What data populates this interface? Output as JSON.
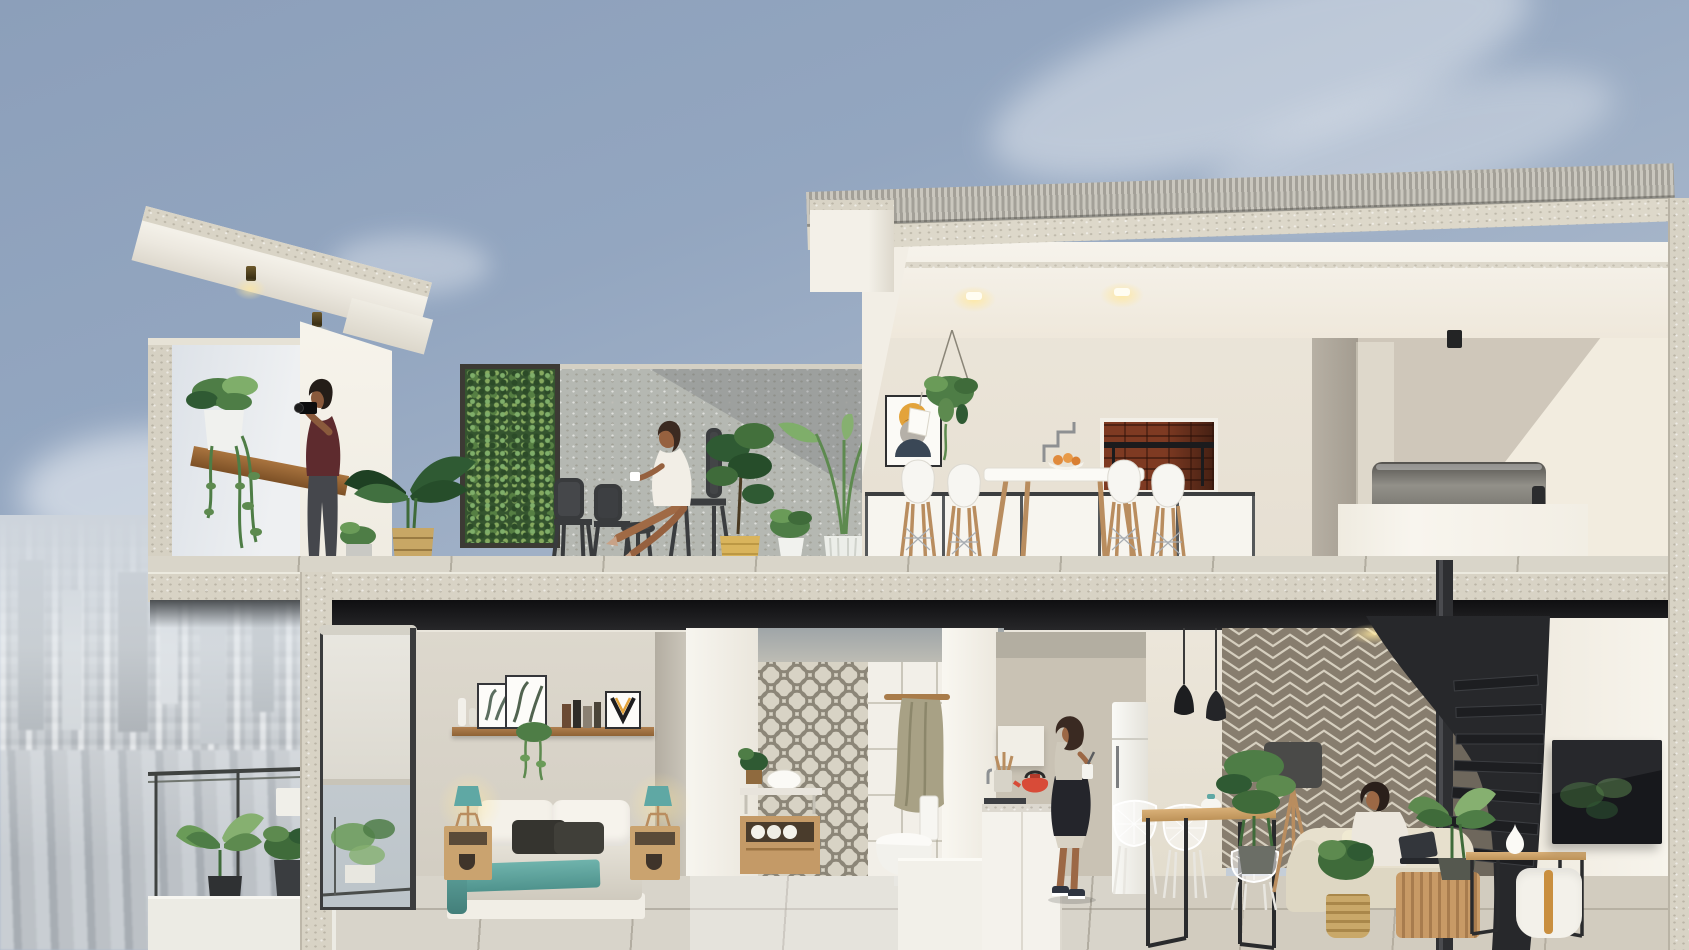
{
  "scene": {
    "type": "architectural cutaway render",
    "title": "Two-storey penthouse cross-section with roof terrace",
    "setting": "High-rise duplex apartment shown in section view against a hazy city skyline",
    "sky": "Soft blue-grey sky with thin cirrus clouds",
    "city": "Dense low-rise cityscape fading into haze at the lower left"
  },
  "palette": {
    "sky_top": "#8c9fba",
    "sky_low": "#cdd4dc",
    "cloud": "#ffffff",
    "concrete_cut": "#d8d3c5",
    "concrete_wall": "#b5b8b2",
    "white_wall": "#f4f1ea",
    "cream_wall": "#e9e3d7",
    "taupe_wall": "#cfc7ba",
    "shadow_gap": "#141416",
    "wood": "#b98d5f",
    "wood_dark": "#8e6234",
    "foliage_dark": "#2f5a33",
    "foliage": "#4e7d46",
    "foliage_light": "#7fae6a",
    "metal_dark": "#3a3c3e",
    "stair_black": "#27282b",
    "maroon_shirt": "#5e2b2e",
    "teal_accent": "#5fa8a4",
    "brick": "#7e3a22",
    "kettle_red": "#d84b38",
    "fruit_orange": "#e08a3c",
    "herringbone_base": "#877d6e",
    "herringbone_line": "#d6cfbf",
    "tile_pattern": "#8c8678",
    "sofa_cream": "#e7e0cd",
    "tv_black": "#17181c",
    "city_grey": "#b3b9bf"
  },
  "upper_floor": {
    "label": "Roof terrace level",
    "open_terrace": {
      "label": "Open roof terrace",
      "objects": [
        "cantilevered concrete canopy with two brass downlights",
        "concrete parapet with timber bar ledge",
        "trailing pothos in white pot",
        "living green wall in dark steel frame",
        "banana plant in woven basket",
        "potted ferns",
        "two dark metal bistro chairs",
        "metal side stool",
        "fiddle-leaf fig in yellow basket",
        "bird-of-paradise palm in white ribbed pot"
      ]
    },
    "covered_bar": {
      "label": "Covered roof kitchen and bar",
      "objects": [
        "corrugated metal roof on concrete fascia",
        "two recessed ceiling downlights",
        "framed abstract print with yellow, ochre, grey and navy circles",
        "hanging plant on ropes",
        "white pendant lamp",
        "brick barbecue niche with steel grill",
        "white high bar table",
        "bowl of oranges",
        "four white bar stools with timber dowel legs",
        "white balustrade with dark mullions",
        "steel plunge hot-tub behind white parapet",
        "black cylindrical ceiling spotlight"
      ]
    },
    "people": [
      {
        "id": "photographer",
        "description": "Bearded man in a maroon t-shirt and grey trousers photographing the view with a DSLR camera"
      },
      {
        "id": "woman_with_coffee",
        "description": "Woman in a white summer dress sitting cross-legged on a metal chair holding a coffee cup"
      }
    ]
  },
  "lower_floor": {
    "label": "Apartment level",
    "balcony": {
      "label": "Bedroom balcony",
      "objects": [
        "dark metal railing",
        "white planter box",
        "potted monstera and philodendron plants",
        "plant stand"
      ]
    },
    "bedroom": {
      "label": "Bedroom",
      "objects": [
        "sliding glass door with roller blind",
        "timber picture shelf",
        "two leaning botanical prints",
        "row of books",
        "letter-V artwork",
        "trailing plant",
        "double bed with grey duvet and teal throw",
        "white and charcoal pillows",
        "two timber nightstands",
        "two teal tripod table lamps"
      ]
    },
    "bathroom": {
      "label": "Bathroom",
      "objects": [
        "grey patterned feature tiles",
        "white wall tiles",
        "timber hook rail with towel",
        "floating timber vanity with vessel basin",
        "rolled towels",
        "potted plant",
        "white toilet",
        "low white partition"
      ]
    },
    "kitchen": {
      "label": "Kitchen",
      "objects": [
        "white counter with stone top",
        "gas hob",
        "red kettle",
        "utensil pot with wooden spoons",
        "tall white fridge"
      ]
    },
    "dining": {
      "label": "Dining nook",
      "objects": [
        "light timber table on black steel frame",
        "white wire chairs",
        "white and teal teapot",
        "two black pendant lamps"
      ]
    },
    "living": {
      "label": "Living room",
      "objects": [
        "taupe herringbone feature wallpaper",
        "black steel spiral staircase",
        "tripod floor lamp with charcoal shade",
        "cream sofa with timber slat base",
        "pale yellow cushion",
        "woven basket",
        "wall-mounted television",
        "timber console table",
        "white ceramic vase",
        "white strap pouf",
        "potted monstera plants",
        "indoor palm"
      ]
    },
    "people": [
      {
        "id": "cook",
        "description": "Woman with a dark bob and black apron preparing food at the kitchen counter"
      },
      {
        "id": "reader_on_sofa",
        "description": "Person with dark curly hair using a laptop on the cream sofa"
      }
    ]
  },
  "structure": {
    "floors": 2,
    "elements": [
      "cut concrete floor slabs",
      "cut party walls",
      "right-hand cut concrete edge",
      "terrace floor joint lines"
    ]
  }
}
